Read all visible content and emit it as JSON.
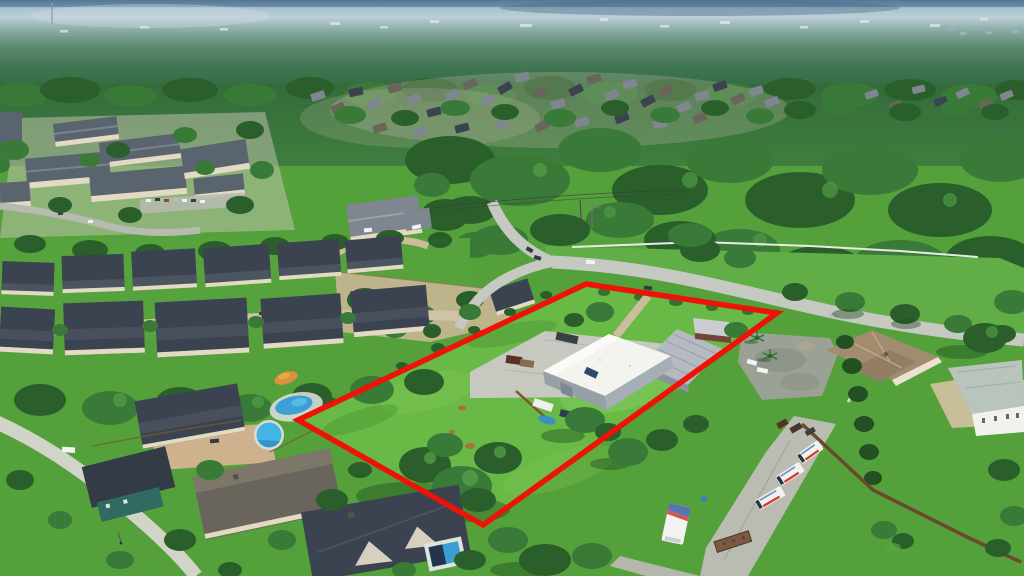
{
  "meta": {
    "type": "aerial-drone-photograph",
    "subject": "Oblique aerial photo of a commercial lot outlined in red: white metal warehouse, gray shop building, shed and green field, bordered by a road, wooded suburbs, apartment complex, residential homes with pools, tan-roof office with parking lot, box vans on a concrete strip and a wooden fence line",
    "visible_text": "none"
  },
  "boundary": {
    "name": "subject-property-boundary",
    "points": "586,284 777,313 483,525 298,420",
    "stroke_width": 5.5
  },
  "colors": {
    "boundary_red": "#ee1209",
    "forest_dark": "#2a5f2b",
    "forest_mid": "#3a7a39",
    "forest_light": "#57a449",
    "tree_shadow": "#1d4a20",
    "grass_base": "#54a03a",
    "grass_field": "#69b946",
    "grass_north": "#61ae47",
    "grass_patch": "#83cc5f",
    "road": "#c6c9c2",
    "street": "#d2d3c9",
    "dirt_street": "#cfc2a7",
    "concrete": "#c7c9c0",
    "strip_concrete": "#babcb2",
    "asphalt_lot": "#9ba195",
    "dirt_tan": "#c9b694",
    "sand": "#d5c2a3",
    "drive_tan": "#cdb28d",
    "roof_gray": "#7f868f",
    "roof_dark": "#3a434f",
    "roof_brown": "#6a655c",
    "apt_roof": "#5a646e",
    "wall_cream": "#e3dac3",
    "warehouse_roof": "#f3f4ee",
    "warehouse_wall": "#97a0a8",
    "metal_roof": "#b4bac0",
    "shed_wall": "#744438",
    "tan_roof": "#a28c6f",
    "tan_roof_ridge": "#c6b090",
    "white_house_roof": "#b9c4bd",
    "wall_white": "#f2f2ec",
    "fence_wood": "#6b4a2c",
    "fence_white": "#e9eae2",
    "pool_blue": "#43b4e4",
    "pool_deep": "#2f85bd",
    "car_white": "#f2f3f0",
    "car_dark": "#343b44",
    "car_silver": "#b9bdc0",
    "truck_red": "#cc3a30",
    "truck_blue": "#3b5ea8",
    "hay_brown": "#a6713d",
    "teal_wall": "#2f6b60",
    "orange_item": "#d8923e",
    "hedge_dark": "#234f23",
    "sky_top": "#5d819c",
    "sky_haze": "#bccfd6",
    "horizon_teal": "#8fafab",
    "distant_forest": "#417753"
  },
  "scene": {
    "regions": [
      {
        "name": "sky-horizon",
        "desc": "hazy blue horizon with distant city specks and radio tower"
      },
      {
        "name": "apartment-complex",
        "desc": "beige 3-story apartment buildings with dark roofs, top-left"
      },
      {
        "name": "north-subdivision",
        "desc": "dense single-family rooftops among trees, upper middle"
      },
      {
        "name": "main-road",
        "desc": "light concrete road curving from center to lower right with cars"
      },
      {
        "name": "subject-property",
        "desc": "red-outlined lot: field, white warehouse, metal shop, shed, vehicles"
      },
      {
        "name": "row-houses",
        "desc": "two rows of dark-roof homes, middle left"
      },
      {
        "name": "bottom-left-homes",
        "desc": "large homes with pools, cul-de-sac street"
      },
      {
        "name": "east-parcel",
        "desc": "tan hip-roof house, aged asphalt lot, palms, white house, sandy drive"
      },
      {
        "name": "truck-yard",
        "desc": "concrete strip with white box vans, box truck, flatbed trailer, wooden fence"
      }
    ]
  }
}
